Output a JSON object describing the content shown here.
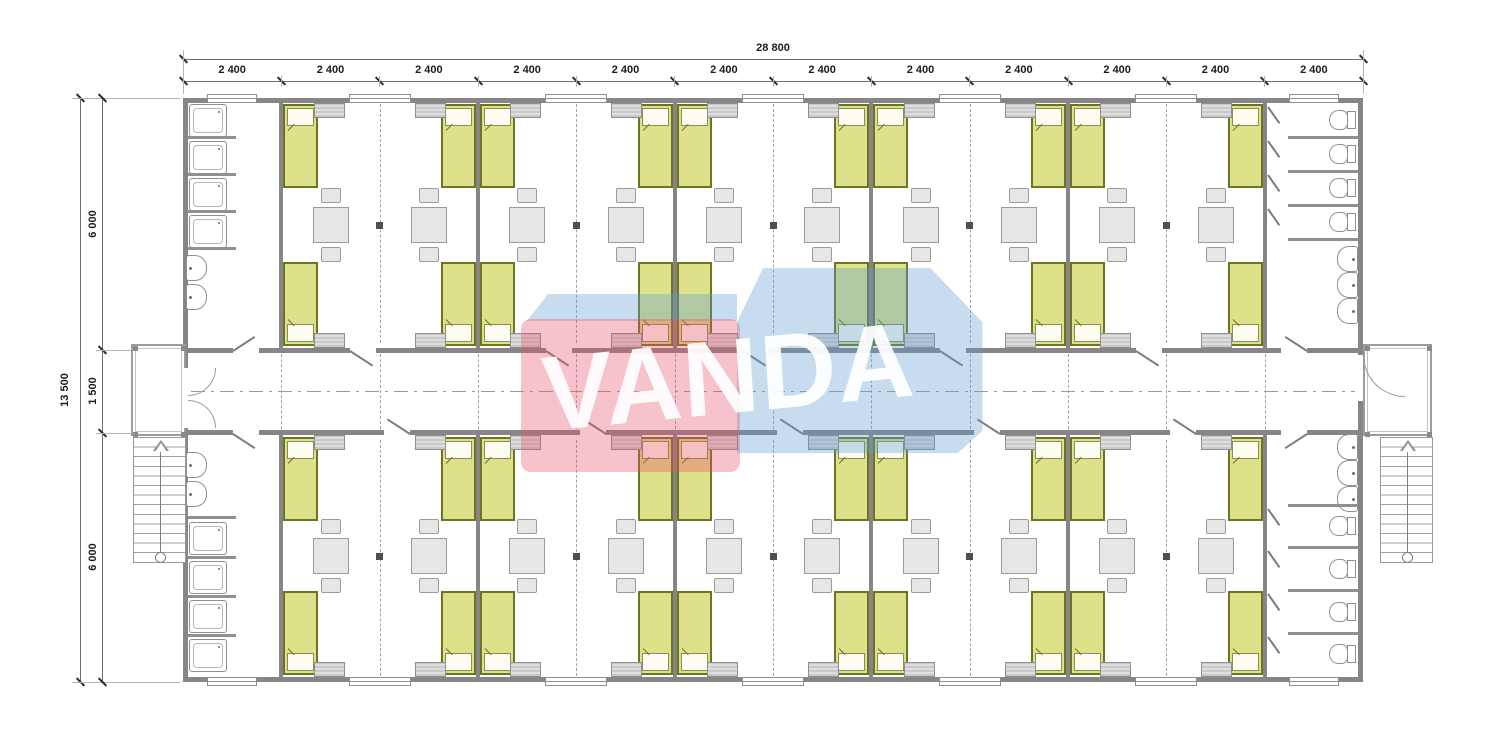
{
  "dimensions": {
    "top": {
      "total": "28 800",
      "bays": [
        "2 400",
        "2 400",
        "2 400",
        "2 400",
        "2 400",
        "2 400",
        "2 400",
        "2 400",
        "2 400",
        "2 400",
        "2 400",
        "2 400"
      ]
    },
    "left": {
      "total": "13 500",
      "segments": [
        "6 000",
        "1 500",
        "6 000"
      ]
    }
  },
  "watermark": {
    "text": "VANDA",
    "pink_color": "#e8506a",
    "blue_color": "#5f9fd0",
    "text_color": "#ffffff"
  },
  "palette": {
    "wall": "#868686",
    "bed_fill": "#dde189",
    "bed_border": "#6e7423",
    "pillow_fill": "#fcfcf0",
    "furniture_fill": "#e6e6e6",
    "furniture_border": "#9b9b9b",
    "locker_fill": "#d6d6d6",
    "fixture_outline": "#8f8f8f",
    "grid_dash": "#a2a2a2",
    "column_marker": "#4f4f4f",
    "dimension_text": "#1c1c1c"
  },
  "inventory": {
    "dorm_rooms": 10,
    "beds": 40,
    "tables": 20,
    "chairs": 40,
    "lockers": 40,
    "showers": 8,
    "wash_basins": 10,
    "toilets": 8,
    "staircases": 2,
    "entrance_porches": 2
  }
}
